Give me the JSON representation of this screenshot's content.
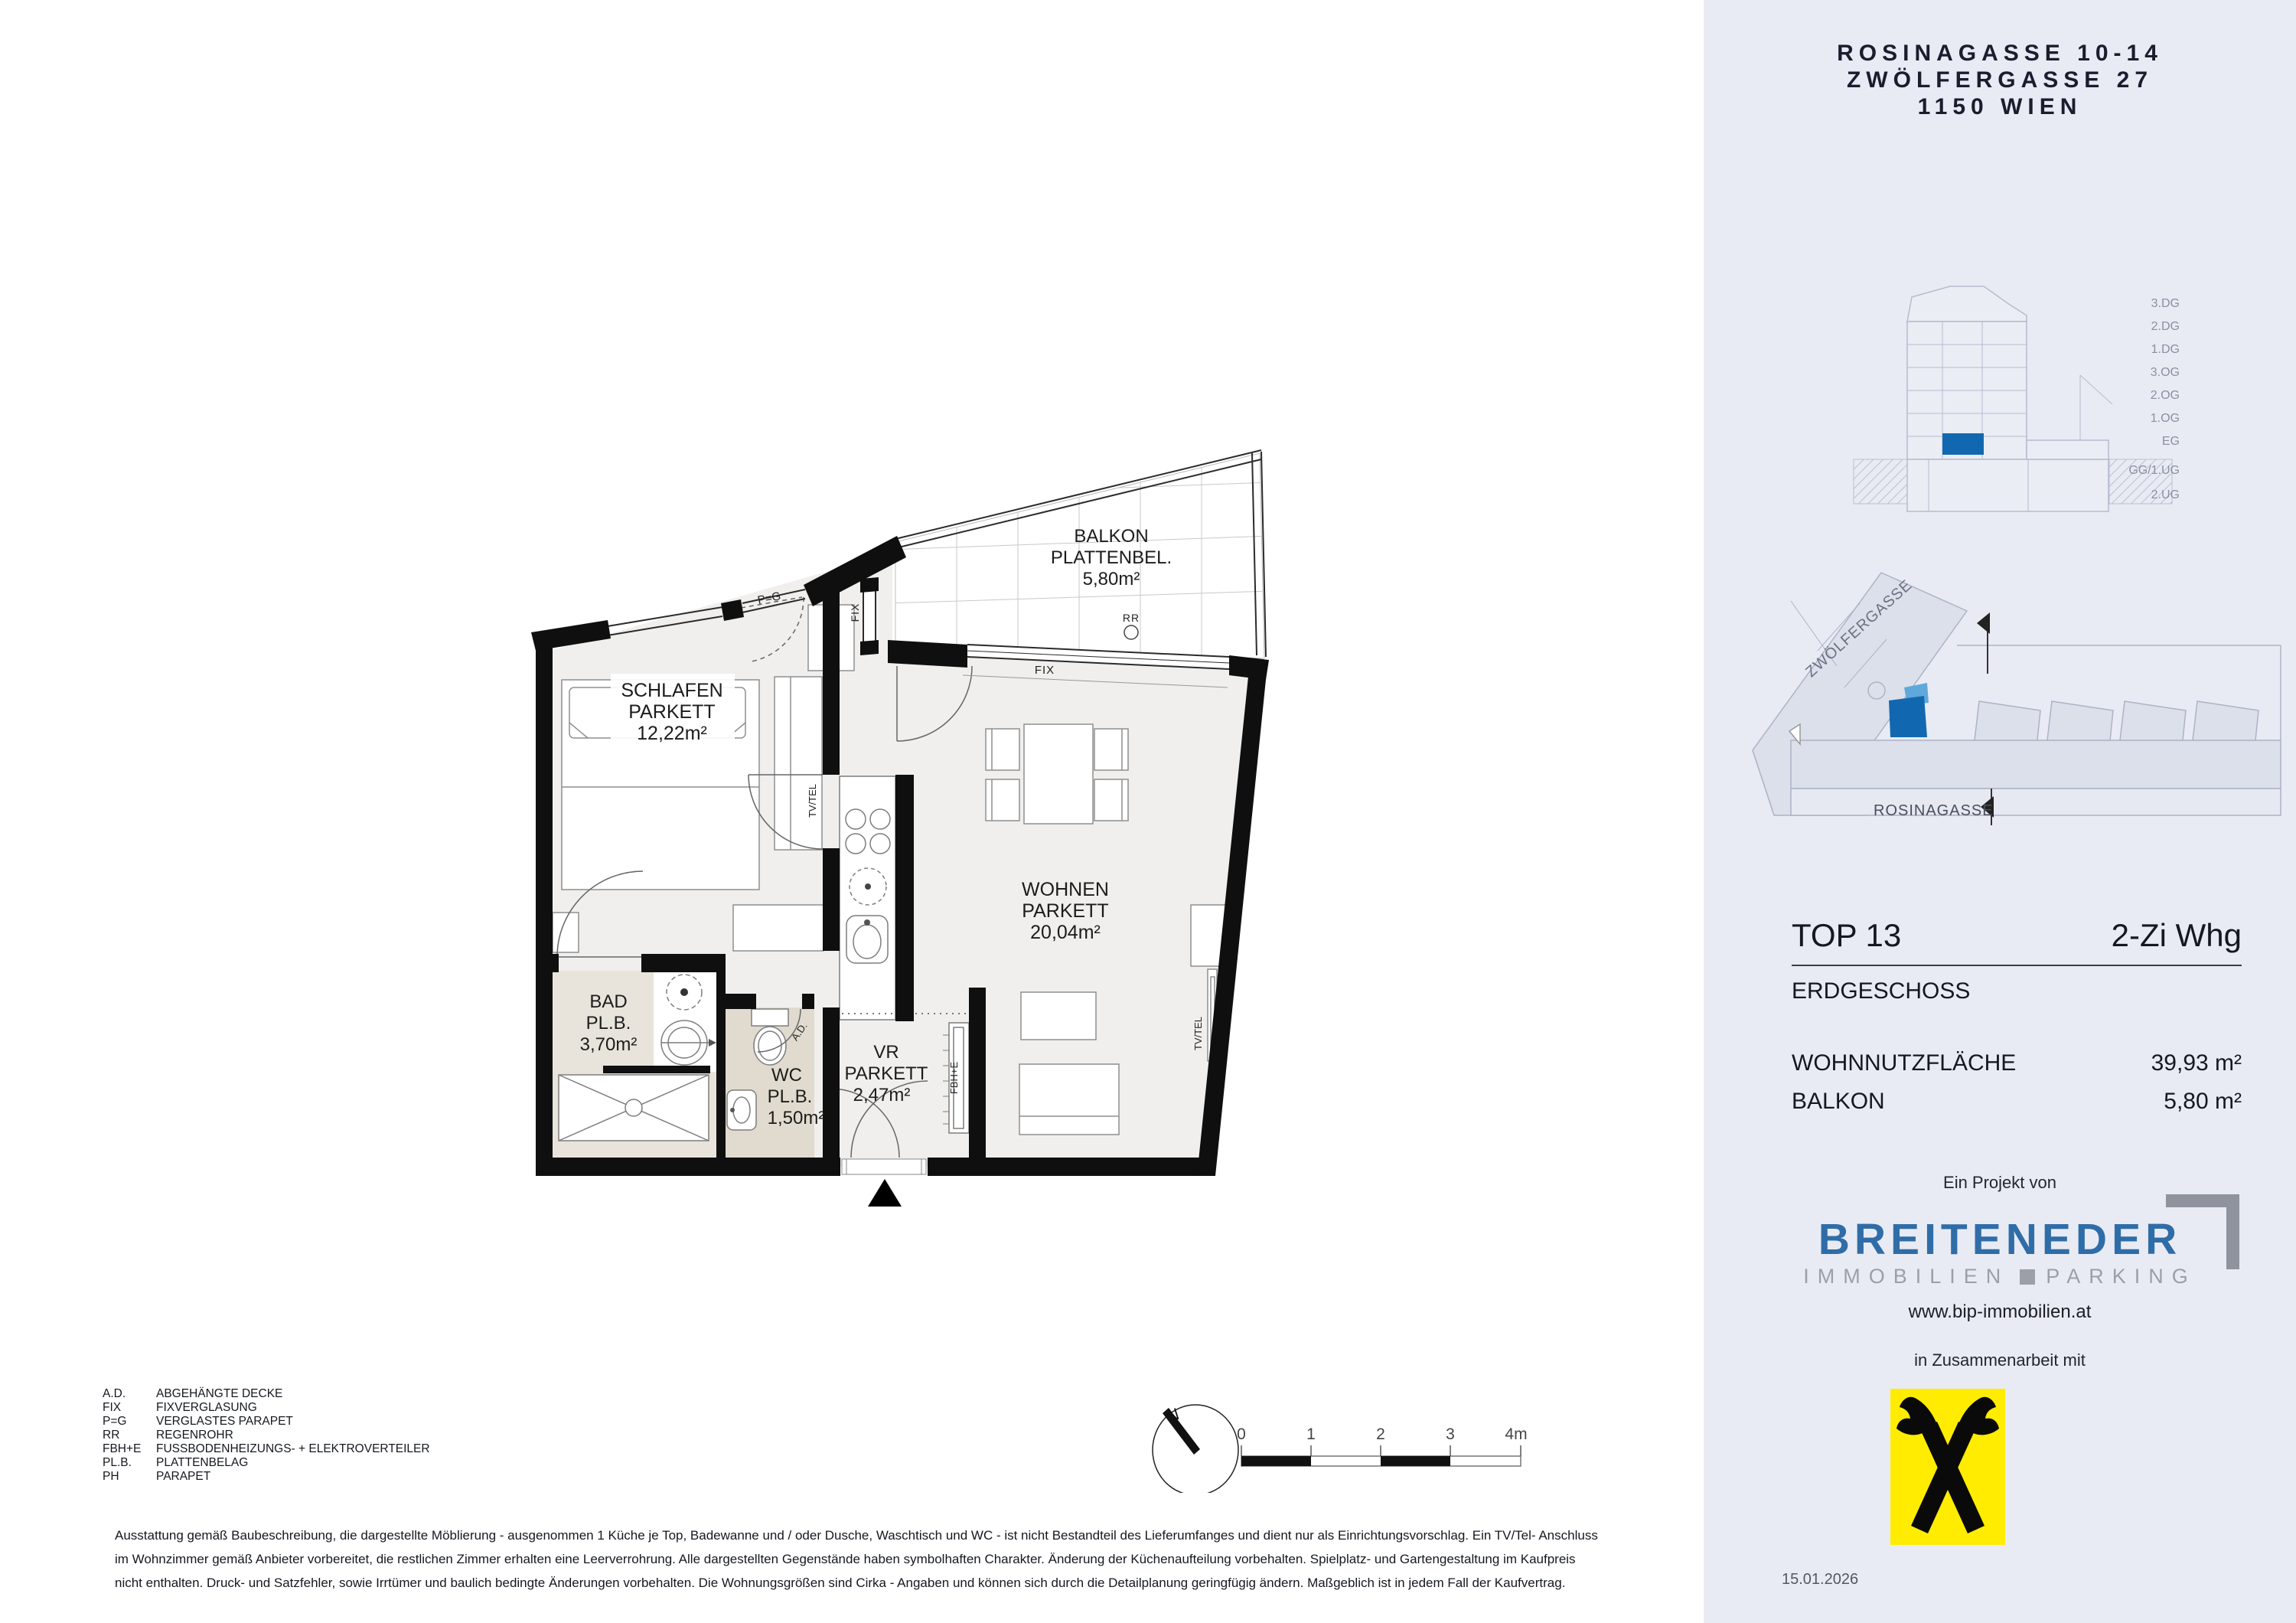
{
  "sidebar": {
    "address_lines": [
      "ROSINAGASSE 10-14",
      "ZWÖLFERGASSE 27",
      "1150 WIEN"
    ],
    "section": {
      "floors": [
        "3.DG",
        "2.DG",
        "1.DG",
        "3.OG",
        "2.OG",
        "1.OG",
        "EG",
        "GG/1.UG",
        "2.UG"
      ]
    },
    "siteplan": {
      "street_top": "ZWÖLFERGASSE",
      "street_bottom": "ROSINAGASSE"
    },
    "unit": {
      "id": "TOP 13",
      "type": "2-Zi Whg",
      "floor": "ERDGESCHOSS",
      "rows": [
        {
          "label": "WOHNNUTZFLÄCHE",
          "value": "39,93 m²"
        },
        {
          "label": "BALKON",
          "value": "5,80 m²"
        }
      ]
    },
    "project": {
      "prefix": "Ein Projekt von",
      "brand": "BREITENEDER",
      "sub_left": "IMMOBILIEN",
      "sub_right": "PARKING",
      "url": "www.bip-immobilien.at",
      "cooperation": "in Zusammenarbeit mit"
    },
    "date": "15.01.2026"
  },
  "plan": {
    "rooms": {
      "balkon": [
        "BALKON",
        "PLATTENBEL.",
        "5,80m²"
      ],
      "schlafen": [
        "SCHLAFEN",
        "PARKETT",
        "12,22m²"
      ],
      "wohnen": [
        "WOHNEN",
        "PARKETT",
        "20,04m²"
      ],
      "bad": [
        "BAD",
        "PL.B.",
        "3,70m²"
      ],
      "wc": [
        "WC",
        "PL.B.",
        "1,50m²"
      ],
      "vr": [
        "VR",
        "PARKETT",
        "2,47m²"
      ]
    },
    "annotations": {
      "fix_top": "FIX",
      "fix_vert": "FIX",
      "pg": "P=G",
      "rr": "RR",
      "tvtel_left": "TV/TEL",
      "tvtel_right": "TV/TEL",
      "fbhe": "FBH+E",
      "ad": "A.D.",
      "north": "N"
    }
  },
  "scalebar": {
    "ticks": [
      "0",
      "1",
      "2",
      "3",
      "4m"
    ]
  },
  "legend": {
    "rows": [
      {
        "abbr": "A.D.",
        "desc": "ABGEHÄNGTE DECKE"
      },
      {
        "abbr": "FIX",
        "desc": "FIXVERGLASUNG"
      },
      {
        "abbr": "P=G",
        "desc": "VERGLASTES PARAPET"
      },
      {
        "abbr": "RR",
        "desc": "REGENROHR"
      },
      {
        "abbr": "FBH+E",
        "desc": "FUSSBODENHEIZUNGS- + ELEKTROVERTEILER"
      },
      {
        "abbr": "PL.B.",
        "desc": "PLATTENBELAG"
      },
      {
        "abbr": "PH",
        "desc": "PARAPET"
      }
    ]
  },
  "disclaimer": {
    "l1": "Ausstattung gemäß Baubeschreibung, die dargestellte Möblierung - ausgenommen 1 Küche je Top, Badewanne und / oder Dusche, Waschtisch und WC - ist nicht Bestandteil des Lieferumfanges und dient nur als Einrichtungsvorschlag. Ein TV/Tel- Anschluss",
    "l2": "im Wohnzimmer gemäß Anbieter vorbereitet, die restlichen Zimmer erhalten eine Leerverrohrung. Alle dargestellten Gegenstände haben symbolhaften Charakter. Änderung der Küchenaufteilung vorbehalten. Spielplatz- und Gartengestaltung im Kaufpreis",
    "l3": "nicht enthalten. Druck- und Satzfehler, sowie Irrtümer und baulich bedingte Änderungen vorbehalten. Die Wohnungsgrößen sind Cirka - Angaben und können sich durch die Detailplanung geringfügig ändern. Maßgeblich ist in jedem Fall der Kaufvertrag."
  },
  "colors": {
    "sidebar_bg": "#E9EBF4",
    "highlight_blue": "#1268B0",
    "highlight_blue_light": "#5FA8DC",
    "brand_blue": "#2F6DA8",
    "brand_gray": "#9BA0A8",
    "raiffeisen_yellow": "#FFEC00",
    "wall_black": "#0F0F0F",
    "floor_light": "#F0EFED",
    "bad_beige": "#E8E4DB",
    "wc_beige": "#E1DBCF"
  }
}
